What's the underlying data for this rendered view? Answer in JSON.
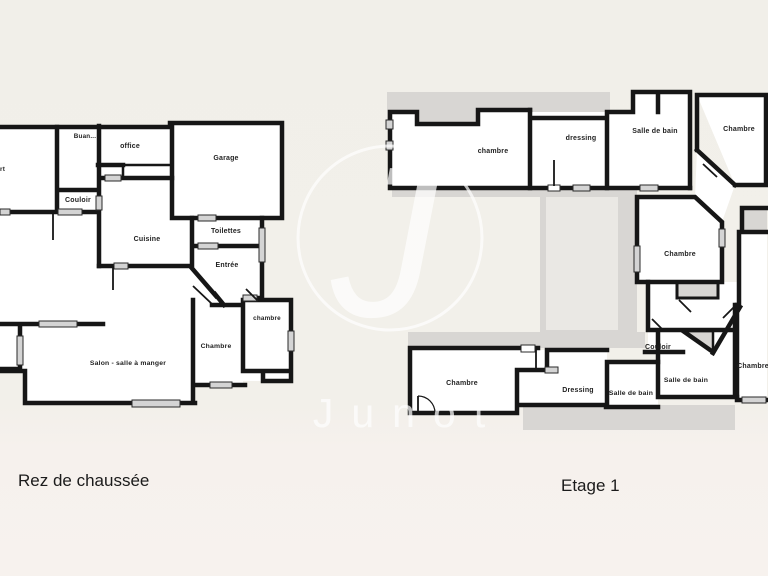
{
  "watermark": {
    "monogram": "J",
    "brand": "Junot"
  },
  "colors": {
    "background": "#f1efe9",
    "wall": "#161616",
    "room_fill": "#ffffff",
    "terrace": "#d8d6d3",
    "terrace_light": "#eae8e4",
    "window_marker": "#d4d4d4",
    "label_text": "#1f1f1f",
    "watermark_color": "#ffffff"
  },
  "ground_floor": {
    "caption": "Rez de chaussée",
    "labels": [
      {
        "text": "Buan..."
      },
      {
        "text": "office"
      },
      {
        "text": "Garage"
      },
      {
        "text": "rt"
      },
      {
        "text": "Couloir"
      },
      {
        "text": "Cuisine"
      },
      {
        "text": "Toilettes"
      },
      {
        "text": "Entrée"
      },
      {
        "text": "chambre"
      },
      {
        "text": "Chambre"
      },
      {
        "text": "Salon - salle à manger"
      }
    ]
  },
  "first_floor": {
    "caption": "Etage 1",
    "labels": [
      {
        "text": "chambre"
      },
      {
        "text": "dressing"
      },
      {
        "text": "Salle de bain"
      },
      {
        "text": "Chambre"
      },
      {
        "text": "Chambre"
      },
      {
        "text": "Couloir"
      },
      {
        "text": "Chambre"
      },
      {
        "text": "Dressing"
      },
      {
        "text": "Salle de bain"
      },
      {
        "text": "Salle de bain"
      },
      {
        "text": "Chambre"
      }
    ]
  }
}
